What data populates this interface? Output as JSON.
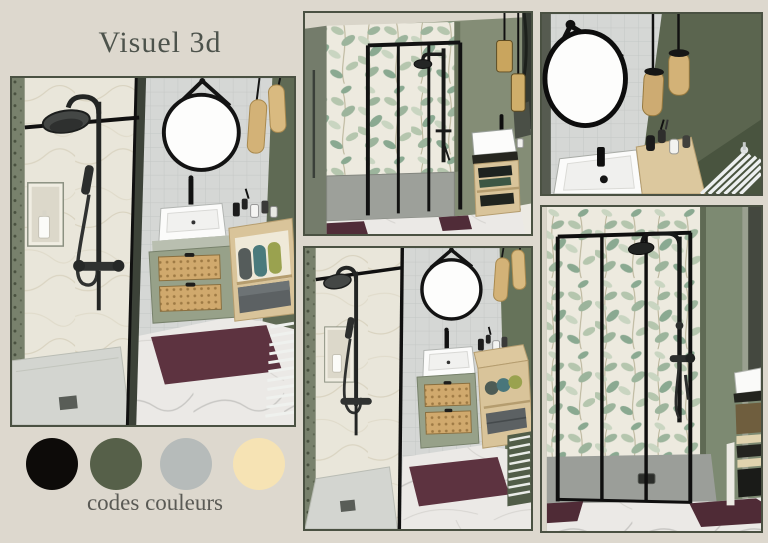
{
  "title": "Visuel 3d",
  "palette": {
    "label": "codes couleurs",
    "swatches": [
      {
        "name": "noir",
        "hex": "#0d0b09"
      },
      {
        "name": "vert kaki",
        "hex": "#566049"
      },
      {
        "name": "gris clair",
        "hex": "#b6bbba"
      },
      {
        "name": "creme",
        "hex": "#f6e3b4"
      }
    ]
  },
  "panels": [
    {
      "id": "main-view",
      "description": "3D corner view of shower and vanity"
    },
    {
      "id": "front-view",
      "description": "Front view of walk-in shower with leaf wallpaper"
    },
    {
      "id": "vanity-closeup",
      "description": "Close-up of round mirror, pendant lights and basin"
    },
    {
      "id": "room-view",
      "description": "Wide 3D view of the full bathroom"
    },
    {
      "id": "shower-closeup",
      "description": "Close-up of black framed shower screen on leaf wallpaper"
    }
  ],
  "scene_colors": {
    "background": "#ddd8ce",
    "panel_border": "#4a5142",
    "title_text": "#4d534c",
    "wall_green": "#7d8a72",
    "wall_green_dark": "#5f6a54",
    "wallpaper_cream": "#edeadf",
    "leaf_green": "#9cb49c",
    "tile_gray": "#d5d7d5",
    "marble_floor": "#ebe9e6",
    "vanity_sage": "#97a189",
    "rattan": "#d0a96d",
    "wood": "#d9c49a",
    "fixture_black": "#161616",
    "mat_burgundy": "#5d3340",
    "pendant_brass": "#d3b277",
    "shower_tray": "#d3d5d0"
  }
}
